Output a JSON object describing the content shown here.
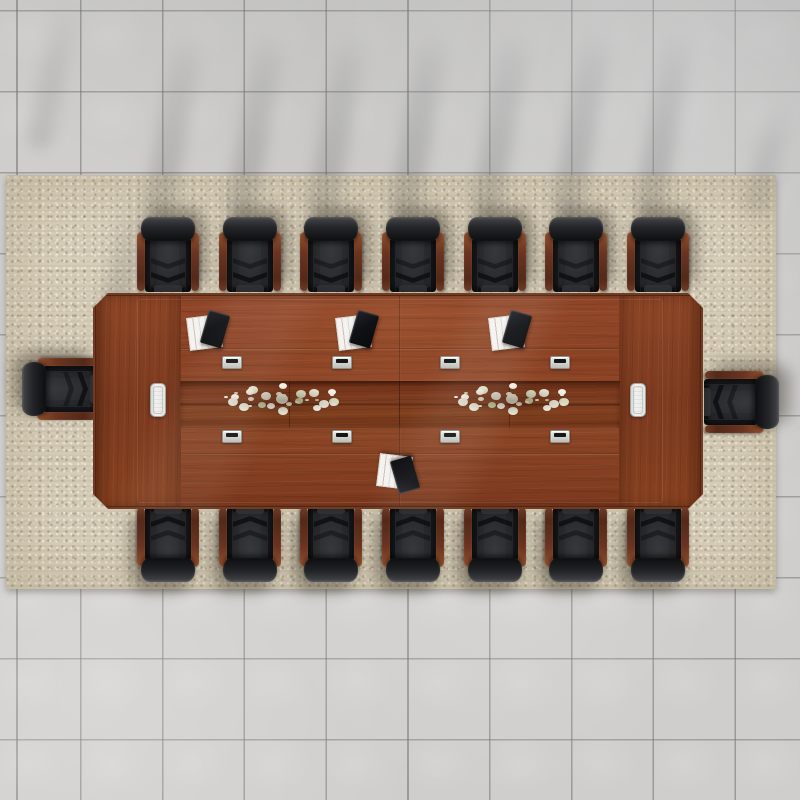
{
  "meta": {
    "scene_description": "Top-down render of a conference room: rectangular chestnut-wood conference table, 16 black leather chairs with wood armrests, beige speckled area rug, gray tile floor",
    "text_content": "none"
  },
  "palette": {
    "tile_gray": "#cfcecc",
    "grout_gray": "#8f8f8d",
    "rug_beige": "#d8cfba",
    "wood_main": "#8a4123",
    "wood_edge": "#5f2a13",
    "wood_light": "#93482a",
    "channel_wood": "#7b3a1f",
    "chair_leather": "#1f2022",
    "chair_wood": "#6b3422",
    "grommet_silver": "#d7d7d5",
    "access_panel_white": "#ededeb",
    "notepad_white": "#f4f3ef",
    "tablet_black": "#101114",
    "flower_white": "#f2f0e4",
    "flower_green": "#cbd3a8"
  },
  "scene": {
    "rug": {
      "x": 6,
      "y": 175,
      "w": 770,
      "h": 414
    },
    "table": {
      "x": 93,
      "y": 293,
      "w": 610,
      "h": 216,
      "chamfer_px": 15,
      "channel": {
        "x": 87,
        "y": 88,
        "w": 440,
        "h": 47
      },
      "seams_y": [
        55,
        160
      ],
      "center_seam_x": 306,
      "access_panels": [
        {
          "x": 57,
          "y": 90
        },
        {
          "x": 537,
          "y": 90
        }
      ],
      "grommets": {
        "xs": [
          139,
          249,
          357,
          467
        ],
        "rows_y": [
          63,
          137
        ],
        "w": 20,
        "h": 13
      },
      "notepad_sets": [
        {
          "x": 95,
          "y": 20,
          "flip": false
        },
        {
          "x": 244,
          "y": 20,
          "flip": false
        },
        {
          "x": 397,
          "y": 20,
          "flip": false
        },
        {
          "x": 285,
          "y": 158,
          "flip": true
        }
      ],
      "centerpieces": [
        {
          "cx": 189,
          "cy": 106
        },
        {
          "cx": 419,
          "cy": 106
        }
      ]
    },
    "chairs": {
      "count": 16,
      "w": 58,
      "l": 74,
      "positions": [
        {
          "cx": 168,
          "cy": 255,
          "rot": 0
        },
        {
          "cx": 250,
          "cy": 255,
          "rot": 0
        },
        {
          "cx": 331,
          "cy": 255,
          "rot": 0
        },
        {
          "cx": 413,
          "cy": 255,
          "rot": 0
        },
        {
          "cx": 495,
          "cy": 255,
          "rot": 0
        },
        {
          "cx": 576,
          "cy": 255,
          "rot": 0
        },
        {
          "cx": 658,
          "cy": 255,
          "rot": 0
        },
        {
          "cx": 168,
          "cy": 544,
          "rot": 180
        },
        {
          "cx": 250,
          "cy": 544,
          "rot": 180
        },
        {
          "cx": 331,
          "cy": 544,
          "rot": 180
        },
        {
          "cx": 413,
          "cy": 544,
          "rot": 180
        },
        {
          "cx": 495,
          "cy": 544,
          "rot": 180
        },
        {
          "cx": 576,
          "cy": 544,
          "rot": 180
        },
        {
          "cx": 658,
          "cy": 544,
          "rot": 180
        },
        {
          "cx": 60,
          "cy": 389,
          "rot": -90
        },
        {
          "cx": 741,
          "cy": 402,
          "rot": 90,
          "shadow": "ne"
        }
      ]
    },
    "shadow_streaks": [
      {
        "x": 160,
        "y": 14,
        "w": 30,
        "h": 205,
        "rot": 10,
        "o": 0.4
      },
      {
        "x": 242,
        "y": 14,
        "w": 30,
        "h": 205,
        "rot": 10,
        "o": 0.42
      },
      {
        "x": 323,
        "y": 14,
        "w": 30,
        "h": 205,
        "rot": 10,
        "o": 0.4
      },
      {
        "x": 405,
        "y": 14,
        "w": 30,
        "h": 205,
        "rot": 10,
        "o": 0.42
      },
      {
        "x": 487,
        "y": 14,
        "w": 30,
        "h": 205,
        "rot": 10,
        "o": 0.4
      },
      {
        "x": 568,
        "y": 14,
        "w": 30,
        "h": 205,
        "rot": 10,
        "o": 0.42
      },
      {
        "x": 650,
        "y": 14,
        "w": 30,
        "h": 205,
        "rot": 10,
        "o": 0.4
      },
      {
        "x": 40,
        "y": 0,
        "w": 26,
        "h": 150,
        "rot": 12,
        "o": 0.28
      },
      {
        "x": 112,
        "y": 192,
        "w": 30,
        "h": 128,
        "rot": 12,
        "o": 0.38
      },
      {
        "x": 756,
        "y": 92,
        "w": 26,
        "h": 125,
        "rot": 14,
        "o": 0.28
      }
    ],
    "flower_colors": [
      "#f2f0e4",
      "#e9e7d8",
      "#f6f5ec",
      "#dde3c6",
      "#cbd3a8",
      "#eceedd"
    ]
  }
}
